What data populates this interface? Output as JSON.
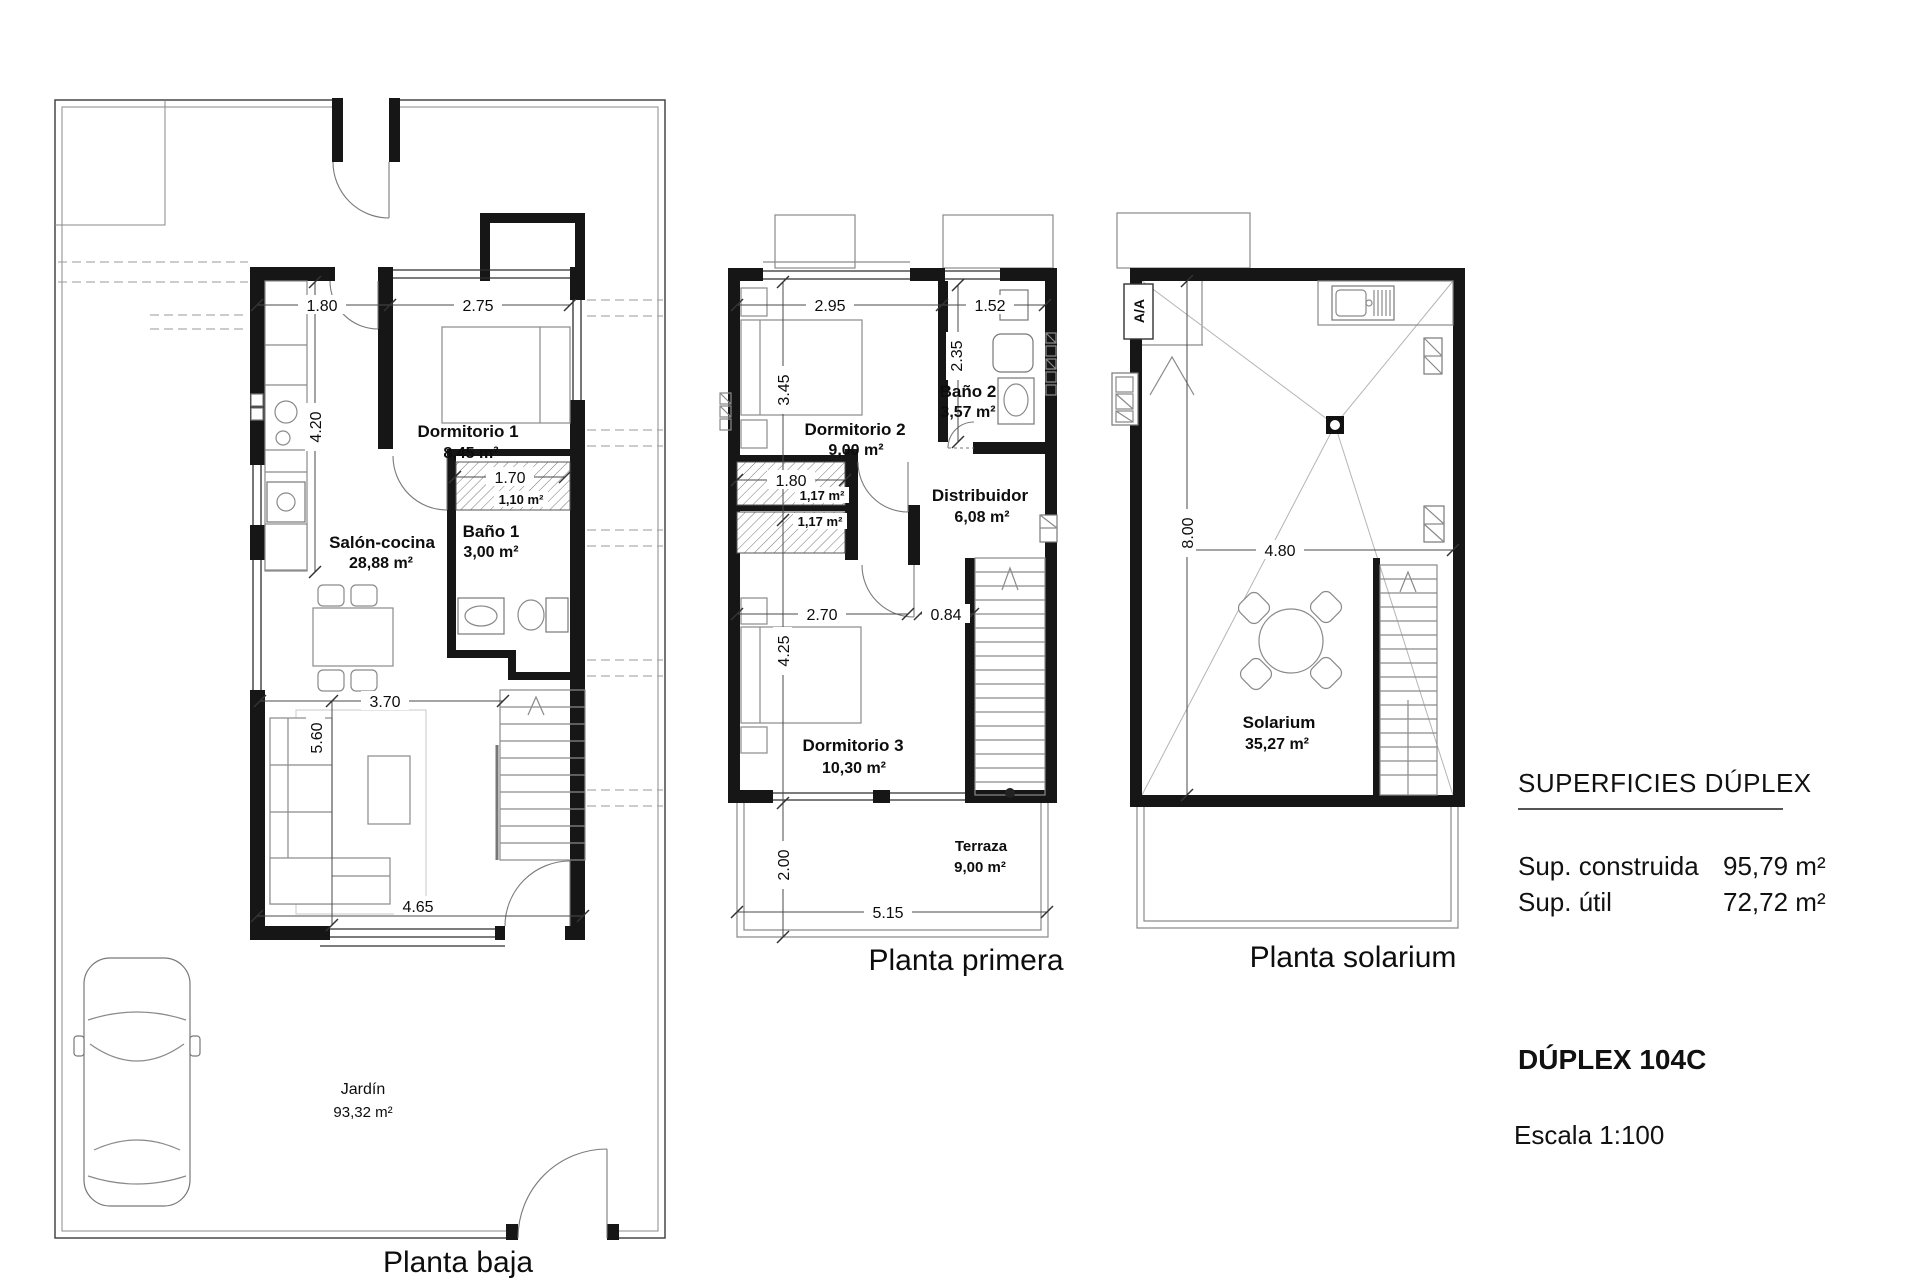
{
  "info_panel": {
    "superficies_title": "SUPERFICIES DÚPLEX",
    "sup_construida_label": "Sup. construida",
    "sup_construida_value": "95,79 m²",
    "sup_util_label": "Sup. útil",
    "sup_util_value": "72,72 m²",
    "unit_title": "DÚPLEX 104C",
    "scale_label": "Escala 1:100"
  },
  "planta_baja": {
    "title": "Planta baja",
    "rooms": {
      "dormitorio1_name": "Dormitorio 1",
      "dormitorio1_area": "8,45 m²",
      "salon_name": "Salón-cocina",
      "salon_area": "28,88 m²",
      "bano1_name": "Baño 1",
      "bano1_area": "3,00 m²",
      "armario_area": "1,10 m²",
      "jardin_name": "Jardín",
      "jardin_area": "93,32 m²"
    },
    "dims": {
      "kitchen_width": "1.80",
      "dorm1_width": "2.75",
      "kitchen_depth": "4.20",
      "armario_width": "1.70",
      "salon_width": "3.70",
      "salon_depth": "5.60",
      "south_width": "4.65"
    }
  },
  "planta_primera": {
    "title": "Planta primera",
    "rooms": {
      "dormitorio2_name": "Dormitorio 2",
      "dormitorio2_area": "9,00 m²",
      "bano2_name": "Baño 2",
      "bano2_area": "3,57 m²",
      "distribuidor_name": "Distribuidor",
      "distribuidor_area": "6,08 m²",
      "dormitorio3_name": "Dormitorio 3",
      "dormitorio3_area": "10,30 m²",
      "terraza_name": "Terraza",
      "terraza_area": "9,00 m²",
      "armario2_area": "1,17 m²",
      "armario3_area": "1,17 m²"
    },
    "dims": {
      "dorm2_width": "2.95",
      "bano2_width": "1.52",
      "dorm2_depth": "3.45",
      "bano2_depth": "2.35",
      "armario_width": "1.80",
      "dorm3_width": "2.70",
      "nook_width": "0.84",
      "dorm3_depth": "4.25",
      "terraza_depth": "2.00",
      "terraza_width": "5.15"
    }
  },
  "planta_solarium": {
    "title": "Planta solarium",
    "rooms": {
      "solarium_name": "Solarium",
      "solarium_area": "35,27 m²"
    },
    "labels": {
      "ac_unit": "A/A"
    },
    "dims": {
      "depth": "8.00",
      "width": "4.80"
    }
  }
}
